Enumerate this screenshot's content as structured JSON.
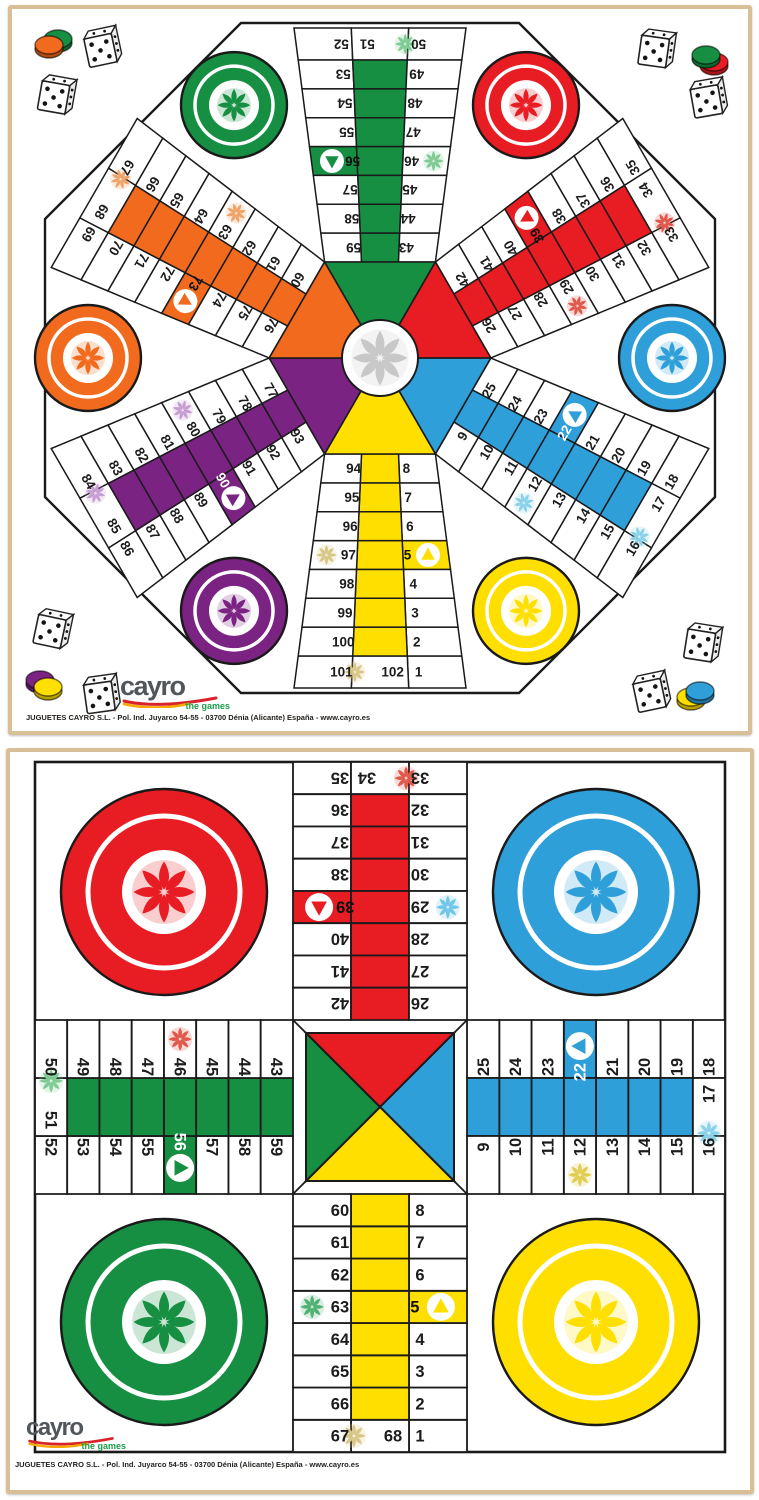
{
  "logo": {
    "brand": "cayro",
    "tagline": "the games",
    "address": "JUGUETES CAYRO S.L. - Pol. Ind. Juyarco 54-55 - 03700 Dénia (Alicante) España - www.cayro.es"
  },
  "colors": {
    "green": "#168f43",
    "red": "#e81c23",
    "blue": "#2f9fd9",
    "yellow": "#ffdf00",
    "purple": "#7b2383",
    "orange": "#f26a1d",
    "line": "#1a1a1a",
    "frame": "#d9bf96",
    "center_star": "#c8c8c8",
    "board_bg": "#ffffff"
  },
  "board6": {
    "description": "six player parchis octagonal board, track 1-102",
    "arms": [
      {
        "id": "green",
        "rot": 0,
        "color": "#168f43",
        "start_text": "#111111",
        "start": 56,
        "left_col": [
          52,
          53,
          54,
          55,
          56,
          57,
          58,
          59
        ],
        "tip": 51,
        "right_col": [
          50,
          49,
          48,
          47,
          46,
          45,
          44,
          43
        ],
        "flowers": {
          "51": "#7fcb94",
          "46": "#7fcb94"
        }
      },
      {
        "id": "red",
        "rot": 60,
        "color": "#e81c23",
        "start_text": "#111111",
        "start": 39,
        "left_col": [
          35,
          36,
          37,
          38,
          39,
          40,
          41,
          42
        ],
        "tip": 34,
        "right_col": [
          33,
          32,
          31,
          30,
          29,
          28,
          27,
          26
        ],
        "flowers": {
          "34": "#e0574b",
          "29": "#e0574b"
        }
      },
      {
        "id": "blue",
        "rot": 120,
        "color": "#2f9fd9",
        "start_text": "#ffffff",
        "start": 22,
        "left_col": [
          18,
          19,
          20,
          21,
          22,
          23,
          24,
          25
        ],
        "tip": 17,
        "right_col": [
          16,
          15,
          14,
          13,
          12,
          11,
          10,
          9
        ],
        "flowers": {
          "17": "#8ad2ea",
          "12": "#8ad2ea"
        }
      },
      {
        "id": "yellow",
        "rot": 180,
        "color": "#ffdf00",
        "start_text": "#111111",
        "start": 5,
        "left_col": [
          1,
          2,
          3,
          4,
          5,
          6,
          7,
          8
        ],
        "tip": 102,
        "right_col": [
          101,
          100,
          99,
          98,
          97,
          96,
          95,
          94
        ],
        "flowers": {
          "102": "#d9c788",
          "97": "#d9c788"
        }
      },
      {
        "id": "purple",
        "rot": 240,
        "color": "#7b2383",
        "start_text": "#ffffff",
        "start": 90,
        "left_col": [
          86,
          87,
          88,
          89,
          90,
          91,
          92,
          93
        ],
        "tip": 85,
        "right_col": [
          84,
          83,
          82,
          81,
          80,
          79,
          78,
          77
        ],
        "flowers": {
          "85": "#c79ed3",
          "80": "#c79ed3"
        }
      },
      {
        "id": "orange",
        "rot": 300,
        "color": "#f26a1d",
        "start_text": "#111111",
        "start": 73,
        "left_col": [
          69,
          70,
          71,
          72,
          73,
          74,
          75,
          76
        ],
        "tip": 68,
        "right_col": [
          67,
          66,
          65,
          64,
          63,
          62,
          61,
          60
        ],
        "flowers": {
          "68": "#efa369",
          "63": "#efa369"
        }
      }
    ],
    "homes": [
      {
        "id": "green",
        "rot": -30,
        "color": "#168f43"
      },
      {
        "id": "red",
        "rot": 30,
        "color": "#e81c23"
      },
      {
        "id": "blue",
        "rot": 90,
        "color": "#2f9fd9"
      },
      {
        "id": "yellow",
        "rot": 150,
        "color": "#ffdf00"
      },
      {
        "id": "purple",
        "rot": 210,
        "color": "#7b2383"
      },
      {
        "id": "orange",
        "rot": 270,
        "color": "#f26a1d"
      }
    ],
    "decorations": [
      {
        "type": "chips",
        "x": 37,
        "y": 36,
        "front": "#f26a1d",
        "back": "#168f43",
        "bdx": 9,
        "bdy": -6
      },
      {
        "type": "die",
        "x": 88,
        "y": 39,
        "rot": -12
      },
      {
        "type": "die",
        "x": 42,
        "y": 86,
        "rot": 10
      },
      {
        "type": "die",
        "x": 642,
        "y": 40,
        "rot": 8
      },
      {
        "type": "chips",
        "x": 694,
        "y": 46,
        "front": "#168f43",
        "back": "#e81c23",
        "bdx": 8,
        "bdy": 7
      },
      {
        "type": "die",
        "x": 694,
        "y": 90,
        "rot": -10
      },
      {
        "type": "die",
        "x": 38,
        "y": 620,
        "rot": 12
      },
      {
        "type": "chips",
        "x": 36,
        "y": 678,
        "front": "#ffdf00",
        "back": "#7b2383",
        "bdx": -8,
        "bdy": -7
      },
      {
        "type": "die",
        "x": 87,
        "y": 686,
        "rot": -8
      },
      {
        "type": "die",
        "x": 688,
        "y": 634,
        "rot": 9
      },
      {
        "type": "die",
        "x": 637,
        "y": 684,
        "rot": -12
      },
      {
        "type": "chips",
        "x": 688,
        "y": 682,
        "front": "#2f9fd9",
        "back": "#ffdf00",
        "bdx": -9,
        "bdy": 6
      }
    ]
  },
  "board4": {
    "description": "classic four player parchis board, track 1-68",
    "arms": [
      {
        "id": "red",
        "rot": 0,
        "color": "#e81c23",
        "start_text": "#111111",
        "start": 39,
        "left_col": [
          35,
          36,
          37,
          38,
          39,
          40,
          41,
          42
        ],
        "tip": 34,
        "right_col": [
          33,
          32,
          31,
          30,
          29,
          28,
          27,
          26
        ],
        "flowers": {
          "34": "#e0574b",
          "29": "#6ec6e8"
        }
      },
      {
        "id": "blue",
        "rot": 90,
        "color": "#2f9fd9",
        "start_text": "#ffffff",
        "start": 22,
        "left_col": [
          18,
          19,
          20,
          21,
          22,
          23,
          24,
          25
        ],
        "tip": 17,
        "right_col": [
          16,
          15,
          14,
          13,
          12,
          11,
          10,
          9
        ],
        "flowers": {
          "17": "#8ad2ea",
          "12": "#e0cd52"
        }
      },
      {
        "id": "yellow",
        "rot": 180,
        "color": "#ffdf00",
        "start_text": "#111111",
        "start": 5,
        "left_col": [
          1,
          2,
          3,
          4,
          5,
          6,
          7,
          8
        ],
        "tip": 68,
        "right_col": [
          67,
          66,
          65,
          64,
          63,
          62,
          61,
          60
        ],
        "flowers": {
          "68": "#d9c788",
          "63": "#51b173"
        }
      },
      {
        "id": "green",
        "rot": 270,
        "color": "#168f43",
        "start_text": "#ffffff",
        "start": 56,
        "left_col": [
          52,
          53,
          54,
          55,
          56,
          57,
          58,
          59
        ],
        "tip": 51,
        "right_col": [
          50,
          49,
          48,
          47,
          46,
          45,
          44,
          43
        ],
        "flowers": {
          "51": "#7fcb94",
          "46": "#e0574b"
        }
      }
    ],
    "corners": [
      {
        "id": "red",
        "pos": "top-left",
        "color": "#e81c23"
      },
      {
        "id": "blue",
        "pos": "top-right",
        "color": "#2f9fd9"
      },
      {
        "id": "green",
        "pos": "bottom-left",
        "color": "#168f43"
      },
      {
        "id": "yellow",
        "pos": "bottom-right",
        "color": "#ffdf00"
      }
    ],
    "center": {
      "top": "#e81c23",
      "right": "#2f9fd9",
      "bottom": "#ffdf00",
      "left": "#168f43"
    }
  }
}
